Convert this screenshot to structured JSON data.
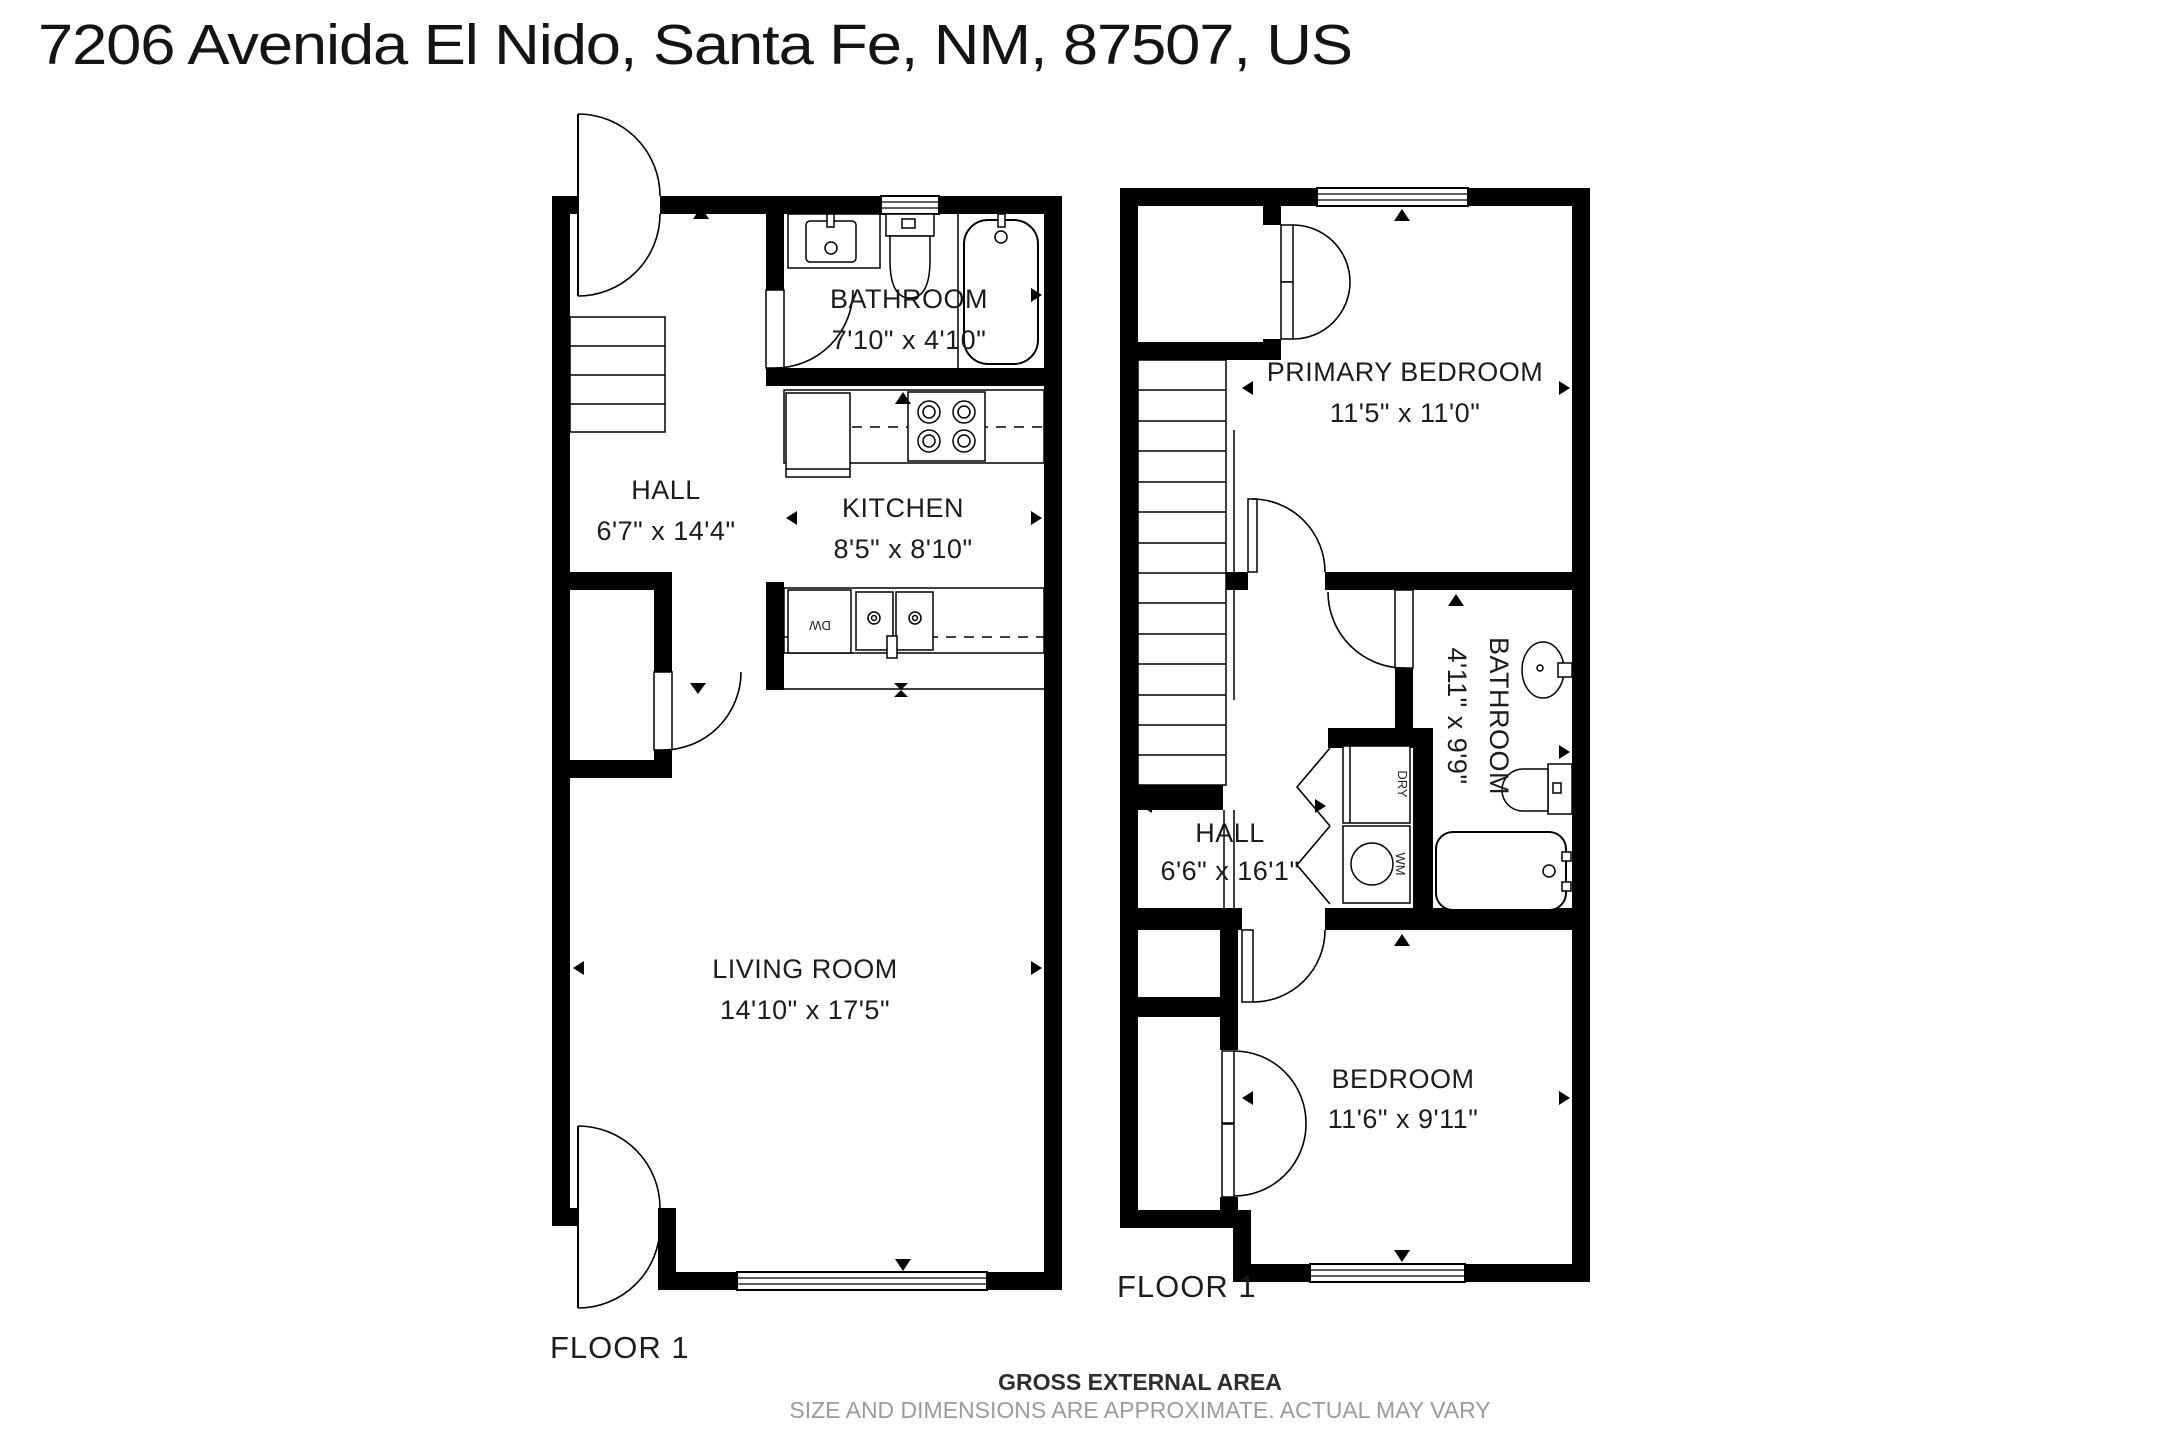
{
  "title": "7206 Avenida El Nido, Santa Fe, NM, 87507, US",
  "floors": {
    "left": {
      "label": "FLOOR 1",
      "rooms": {
        "bathroom": {
          "name": "BATHROOM",
          "dims": "7'10\" x 4'10\""
        },
        "hall": {
          "name": "HALL",
          "dims": "6'7\" x 14'4\""
        },
        "kitchen": {
          "name": "KITCHEN",
          "dims": "8'5\" x 8'10\""
        },
        "living": {
          "name": "LIVING ROOM",
          "dims": "14'10\" x 17'5\""
        }
      },
      "appliances": {
        "dishwasher": "DW"
      }
    },
    "right": {
      "label": "FLOOR 1",
      "rooms": {
        "primary": {
          "name": "PRIMARY BEDROOM",
          "dims": "11'5\" x 11'0\""
        },
        "bathroom": {
          "name": "BATHROOM",
          "dims": "4'11\" x 9'9\""
        },
        "hall": {
          "name": "HALL",
          "dims": "6'6\" x 16'1\""
        },
        "bedroom": {
          "name": "BEDROOM",
          "dims": "11'6\" x 9'11\""
        }
      },
      "appliances": {
        "dryer": "DRY",
        "washer": "WM"
      }
    }
  },
  "footer": {
    "line1": "GROSS EXTERNAL AREA",
    "line2": "SIZE AND DIMENSIONS ARE APPROXIMATE. ACTUAL MAY VARY"
  },
  "colors": {
    "wall": "#000000",
    "background": "#ffffff",
    "footer_muted": "#9b9b9b"
  }
}
